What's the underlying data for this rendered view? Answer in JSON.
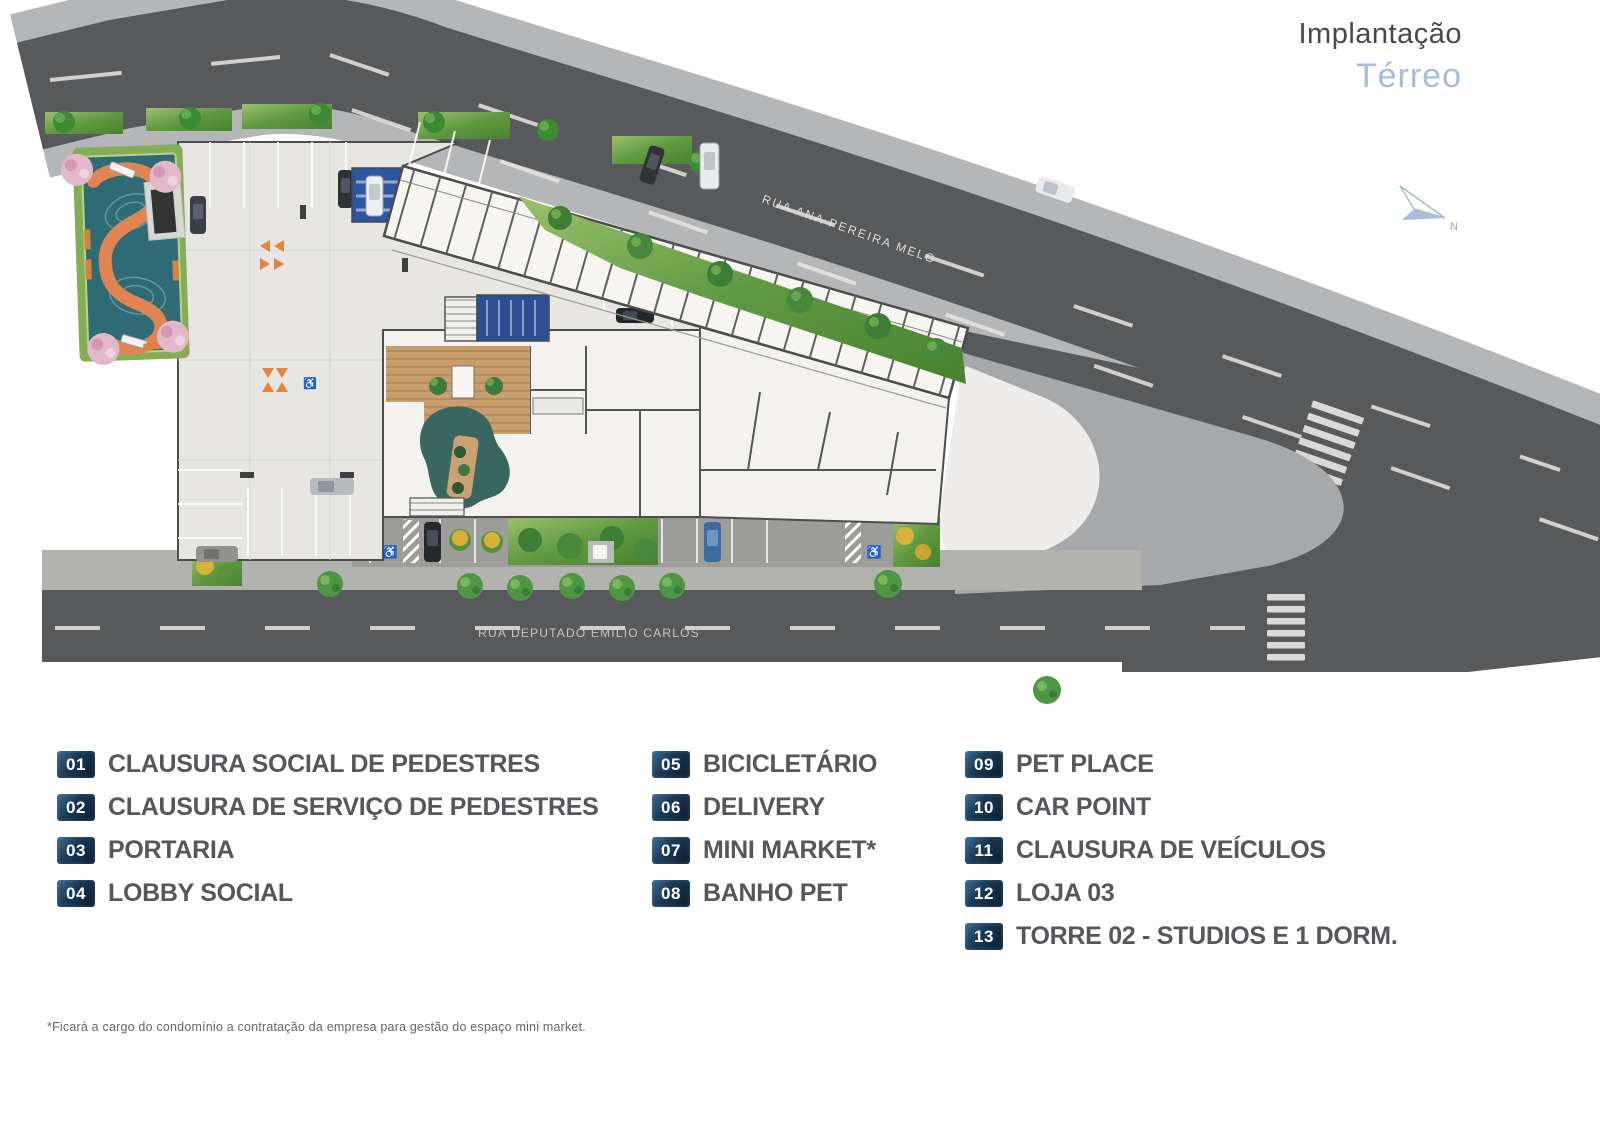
{
  "header": {
    "title": "Implantação",
    "subtitle": "Térreo"
  },
  "compass": {
    "label": "N"
  },
  "map": {
    "streets": {
      "top": "RUA ANA PEREIRA MELO",
      "bottom": "RUA DEPUTADO EMÍLIO CARLOS"
    },
    "areas": [
      "playground",
      "parking-garage",
      "lobby",
      "tower-02-units",
      "pet-place",
      "plaza"
    ]
  },
  "icons": {
    "accessible": "♿"
  },
  "colors": {
    "road": "#58595b",
    "sidewalk": "#b5b6b8",
    "site_floor": "#e7e6e2",
    "plaza": "#eeedeb",
    "teal_playground": "#2f6b74",
    "track_orange": "#e08552",
    "hedge_green": "#5f9a42",
    "wood": "#c99e6e",
    "pond": "#39675f",
    "blue_room": "#2b4f92",
    "badge_navy": "#11293f",
    "title_blue": "#a6bcdf",
    "accent_orange": "#e8823e"
  },
  "legend": {
    "columns": [
      {
        "items": [
          {
            "num": "01",
            "label": "CLAUSURA SOCIAL DE PEDESTRES"
          },
          {
            "num": "02",
            "label": "CLAUSURA DE SERVIÇO DE PEDESTRES"
          },
          {
            "num": "03",
            "label": "PORTARIA"
          },
          {
            "num": "04",
            "label": "LOBBY SOCIAL"
          }
        ]
      },
      {
        "items": [
          {
            "num": "05",
            "label": "BICICLETÁRIO"
          },
          {
            "num": "06",
            "label": "DELIVERY"
          },
          {
            "num": "07",
            "label": "MINI MARKET*"
          },
          {
            "num": "08",
            "label": "BANHO PET"
          }
        ]
      },
      {
        "items": [
          {
            "num": "09",
            "label": "PET PLACE"
          },
          {
            "num": "10",
            "label": "CAR POINT"
          },
          {
            "num": "11",
            "label": "CLAUSURA DE VEÍCULOS"
          },
          {
            "num": "12",
            "label": "LOJA 03"
          },
          {
            "num": "13",
            "label": "TORRE 02 - STUDIOS E 1 DORM."
          }
        ]
      }
    ]
  },
  "footnote": "*Ficará a cargo do condomínio a contratação da empresa para gestão do espaço mini market."
}
